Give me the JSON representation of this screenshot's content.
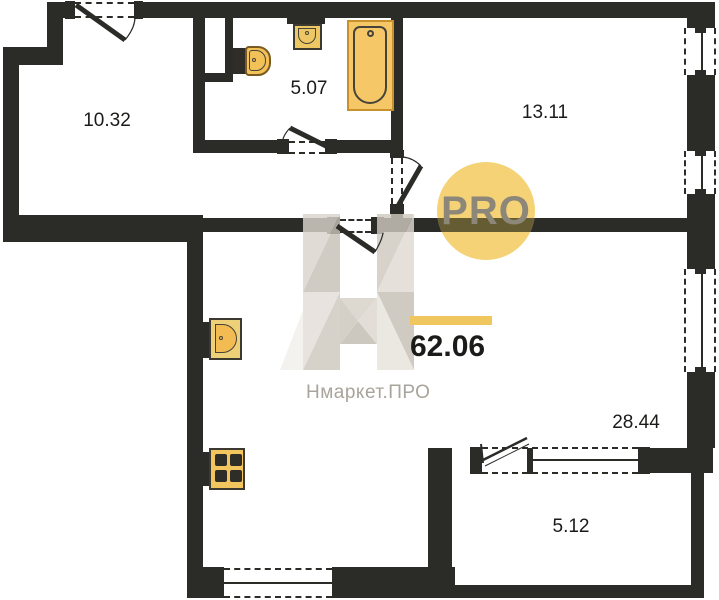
{
  "plan": {
    "type": "apartment-floor-plan",
    "total_area": "62.06",
    "brand": {
      "pro_badge": "PRO",
      "name": "Нмаркет.ПРО",
      "watermark_letter": "H"
    },
    "rooms": [
      {
        "name": "hallway",
        "area": "10.32"
      },
      {
        "name": "bathroom",
        "area": "5.07"
      },
      {
        "name": "bedroom",
        "area": "13.11"
      },
      {
        "name": "kitchen-living-room",
        "area": "28.44"
      },
      {
        "name": "balcony",
        "area": "5.12"
      }
    ],
    "fixtures": [
      "toilet",
      "bath-sink",
      "bathtub",
      "kitchen-sink",
      "stove"
    ],
    "colors": {
      "wall": "#2B2B28",
      "fixture_fill": "#F5C766",
      "fixture_fill_light": "#EDD078",
      "fixture_border": "#C9912C",
      "pro_circle": "#F5D276",
      "pro_text": "#8D8779",
      "underline_yellow": "#EFC75E",
      "brand_gray": "#A9A49B",
      "label_color": "#1B1B19"
    }
  }
}
